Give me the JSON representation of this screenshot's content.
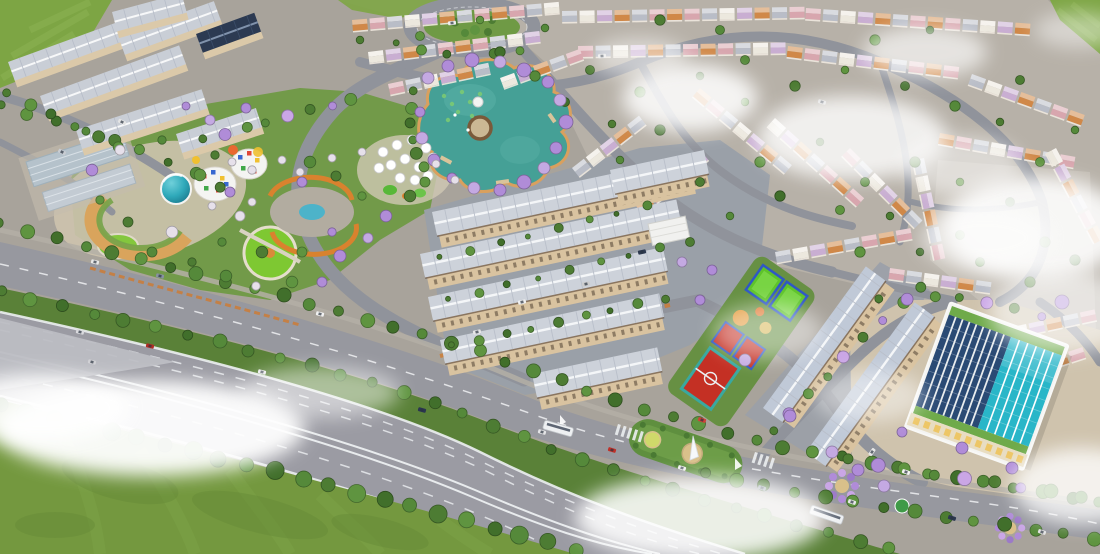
{
  "scene": {
    "type": "aerial-3d-render",
    "description": "Bird's-eye 3D architectural rendering of a master-planned township: parallel rows of shophouses, villa neighborhoods, a clover-shaped lake ringed with purple blossom trees, central park with colorful kindergarten, sports courts, a glass commercial tower, tree-lined boulevard, multi-lane highway and low drifting clouds.",
    "visible_text": []
  },
  "colors": {
    "base": "#a8a39b",
    "fieldGreen": "#7da544",
    "fieldLight": "#8db354",
    "grass": "#74983f",
    "grassDark": "#688c39",
    "treeGreen": "#4d7c33",
    "treeLight": "#61913d",
    "treeDark": "#3f6b2a",
    "treePurple": "#b08cd8",
    "treeWhite": "#e6e0ea",
    "road": "#90939b",
    "roadLight": "#9da3ab",
    "highway": "#9b9ba3",
    "gore": "#bcbdc3",
    "laneWhite": "#eceff1",
    "boulevard": "#97989f",
    "median": "#5a8138",
    "sidewalk": "#b4afa6",
    "villaGround": "#b7b1a8",
    "courtyard": "#c6c0b6",
    "lake": "#45a096",
    "lakeLight": "#5cb2a8",
    "lakeShore": "#d9a05e",
    "lily": "#7ac973",
    "island": "#cbb894",
    "islandRing": "#7a5a3a",
    "shopRoof": "#cdd2da",
    "shopRoofB": "#c0c9d7",
    "shopFacade": "#d9c3a0",
    "shopEave": "#6f5b49",
    "asphalt": "#9aa0a8",
    "aptRoof": "#c9ced6",
    "aptFacade": "#dbc9a9",
    "navyRoof": "#2c3a52",
    "warehouseA": "#b5c2cb",
    "warehouseB": "#c3cbd3",
    "plaza": "#cfc3ad",
    "parkGreen": "#6f9a45",
    "lawnBright": "#7ec832",
    "pathOrange": "#d9822e",
    "pathCream": "#e4ddcc",
    "pondBlue": "#4db3c9",
    "white": "#f4f4f2",
    "towerTeal": "#2fa9ba",
    "towerTealDark": "#19768a",
    "glassDark": "#2a4a74",
    "glassTeal": "#29b6c8",
    "mullion": "#e8ecee",
    "buildingGreen": "#6faa4a",
    "apron": "#e8ddc2",
    "apronWin": "#edc35c",
    "courtRed": "#c43024",
    "courtTealBorder": "#3aa8a0",
    "courtBlueBorder": "#2f58c4",
    "courtGreen": "#5ec32a",
    "courtGreenLight": "#7ed84a",
    "playOrange": "#e39a3a",
    "sandTan": "#d9c08a",
    "monumentGreen": "#5f8f3f",
    "hedge": "#4a7a33",
    "sailWhite": "#f6f8fa",
    "busWhite": "#eef0f2",
    "cloud": "#ffffff",
    "villaWall": "#efe9df"
  },
  "palettes": {
    "villaRoofs": [
      "#d08848",
      "#d8a6ae",
      "#b9bdc7",
      "#ece8de",
      "#c9aed2",
      "#d08848",
      "#b9bdc7",
      "#d8a6ae"
    ],
    "greens": [
      "#4d7c33",
      "#5f9440",
      "#416f2b",
      "#55893a"
    ],
    "mix": [
      "#4d7c33",
      "#b08cd8",
      "#5f9440",
      "#55893a",
      "#caa6e6"
    ],
    "parkMix": [
      "#4d7c33",
      "#5f9440",
      "#b08cd8",
      "#e6e0ea",
      "#55893a"
    ]
  },
  "villaRows": [
    [
      352,
      20,
      -5,
      12,
      0
    ],
    [
      562,
      11,
      -1,
      14,
      2
    ],
    [
      806,
      8,
      4,
      13,
      1
    ],
    [
      368,
      52,
      -7,
      10,
      3
    ],
    [
      578,
      46,
      -1,
      12,
      1
    ],
    [
      788,
      46,
      7,
      10,
      0
    ],
    [
      972,
      74,
      20,
      7,
      2
    ],
    [
      700,
      88,
      40,
      7,
      0
    ],
    [
      775,
      118,
      42,
      7,
      3
    ],
    [
      850,
      148,
      45,
      6,
      1
    ],
    [
      924,
      158,
      78,
      6,
      2
    ],
    [
      940,
      133,
      10,
      8,
      0
    ],
    [
      1056,
      148,
      62,
      6,
      3
    ],
    [
      935,
      395,
      -18,
      9,
      1
    ],
    [
      960,
      338,
      -12,
      8,
      0
    ],
    [
      572,
      168,
      -38,
      5,
      2
    ],
    [
      636,
      206,
      -40,
      5,
      0
    ],
    [
      775,
      252,
      -10,
      8,
      2
    ],
    [
      890,
      268,
      8,
      6,
      1
    ],
    [
      500,
      78,
      -20,
      5,
      3
    ],
    [
      388,
      84,
      -12,
      6,
      1
    ]
  ],
  "aptRows": [
    [
      8,
      62,
      -20,
      118,
      0
    ],
    [
      40,
      96,
      -20,
      148,
      0
    ],
    [
      76,
      130,
      -18,
      132,
      0
    ],
    [
      118,
      36,
      -20,
      102,
      0
    ],
    [
      176,
      134,
      -18,
      84,
      0
    ],
    [
      196,
      34,
      -20,
      62,
      1
    ],
    [
      112,
      12,
      -15,
      72,
      0
    ]
  ],
  "shopRows": [
    [
      432,
      212,
      264
    ],
    [
      420,
      254,
      262
    ],
    [
      428,
      297,
      240
    ],
    [
      440,
      340,
      224
    ],
    [
      532,
      374,
      128
    ],
    [
      610,
      170,
      96
    ]
  ],
  "rightRows": [
    [
      763,
      408,
      175
    ],
    [
      806,
      452,
      185
    ]
  ],
  "treeLines": [
    {
      "pts": [
        [
          0,
          224
        ],
        [
          260,
          290
        ],
        [
          470,
          348
        ],
        [
          620,
          402
        ],
        [
          760,
          442
        ],
        [
          900,
          468
        ],
        [
          1100,
          502
        ]
      ],
      "n": 40,
      "r": 6,
      "pal": "greens"
    },
    {
      "pts": [
        [
          0,
          292
        ],
        [
          220,
          342
        ],
        [
          400,
          390
        ],
        [
          510,
          432
        ],
        [
          610,
          470
        ],
        [
          700,
          498
        ],
        [
          800,
          526
        ],
        [
          890,
          548
        ]
      ],
      "n": 30,
      "r": 6,
      "pal": "greens"
    },
    {
      "pts": [
        [
          0,
          406
        ],
        [
          180,
          448
        ],
        [
          340,
          488
        ],
        [
          480,
          524
        ],
        [
          575,
          550
        ]
      ],
      "n": 22,
      "r": 8,
      "pal": "greens"
    },
    {
      "pts": [
        [
          705,
          474
        ],
        [
          840,
          500
        ],
        [
          980,
          522
        ],
        [
          1095,
          538
        ]
      ],
      "n": 14,
      "r": 6,
      "pal": "greens"
    },
    {
      "pts": [
        [
          848,
          460
        ],
        [
          960,
          478
        ],
        [
          1080,
          496
        ]
      ],
      "n": 9,
      "r": 6,
      "pal": "mix"
    },
    {
      "pts": [
        [
          452,
          346
        ],
        [
          560,
          322
        ],
        [
          665,
          298
        ]
      ],
      "n": 9,
      "r": 4,
      "pal": "greens"
    },
    {
      "pts": [
        [
          204,
          140
        ],
        [
          280,
          118
        ],
        [
          352,
          100
        ]
      ],
      "n": 8,
      "r": 5,
      "pal": "mix"
    },
    {
      "pts": [
        [
          415,
          92
        ],
        [
          408,
          132
        ],
        [
          424,
          168
        ]
      ],
      "n": 6,
      "r": 5,
      "pal": "greens"
    },
    {
      "pts": [
        [
          772,
          432
        ],
        [
          830,
          372
        ],
        [
          882,
          320
        ],
        [
          922,
          286
        ]
      ],
      "n": 9,
      "r": 5,
      "pal": "mix"
    },
    {
      "pts": [
        [
          0,
          106
        ],
        [
          80,
          128
        ],
        [
          160,
          158
        ],
        [
          222,
          186
        ]
      ],
      "n": 9,
      "r": 5,
      "pal": "greens"
    },
    {
      "pts": [
        [
          6,
          94
        ],
        [
          60,
          118
        ],
        [
          120,
          148
        ]
      ],
      "n": 6,
      "r": 5,
      "pal": "greens"
    },
    {
      "pts": [
        [
          448,
          300
        ],
        [
          560,
          272
        ],
        [
          660,
          248
        ]
      ],
      "n": 8,
      "r": 3.5,
      "pal": "greens"
    },
    {
      "pts": [
        [
          440,
          258
        ],
        [
          550,
          230
        ],
        [
          648,
          206
        ]
      ],
      "n": 8,
      "r": 3.5,
      "pal": "greens"
    },
    {
      "pts": [
        [
          880,
          300
        ],
        [
          960,
          296
        ],
        [
          1040,
          316
        ]
      ],
      "n": 7,
      "r": 5,
      "pal": "mix"
    },
    {
      "pts": [
        [
          398,
          44
        ],
        [
          452,
          56
        ],
        [
          520,
          52
        ]
      ],
      "n": 6,
      "r": 4,
      "pal": "greens"
    }
  ],
  "treePoints": [
    [
      360,
      40
    ],
    [
      420,
      36
    ],
    [
      500,
      52
    ],
    [
      545,
      28
    ],
    [
      590,
      70
    ],
    [
      640,
      92
    ],
    [
      700,
      76
    ],
    [
      745,
      60
    ],
    [
      795,
      86
    ],
    [
      845,
      70
    ],
    [
      905,
      86
    ],
    [
      955,
      106
    ],
    [
      1000,
      122
    ],
    [
      1040,
      162
    ],
    [
      660,
      130
    ],
    [
      620,
      160
    ],
    [
      700,
      182
    ],
    [
      760,
      162
    ],
    [
      820,
      142
    ],
    [
      865,
      182
    ],
    [
      915,
      162
    ],
    [
      960,
      182
    ],
    [
      1010,
      202
    ],
    [
      1045,
      242
    ],
    [
      890,
      216
    ],
    [
      840,
      210
    ],
    [
      780,
      196
    ],
    [
      730,
      216
    ],
    [
      690,
      242
    ],
    [
      860,
      252
    ],
    [
      920,
      252
    ],
    [
      980,
      262
    ],
    [
      1030,
      282
    ],
    [
      745,
      102
    ],
    [
      565,
      102
    ],
    [
      535,
      76
    ],
    [
      612,
      124
    ],
    [
      960,
      235
    ],
    [
      1075,
      260
    ],
    [
      1075,
      130
    ],
    [
      1020,
      80
    ],
    [
      875,
      40
    ],
    [
      930,
      30
    ],
    [
      720,
      30
    ],
    [
      660,
      20
    ],
    [
      480,
      20
    ]
  ],
  "parkTrees": [
    [
      215,
      155
    ],
    [
      200,
      175
    ],
    [
      230,
      192
    ],
    [
      252,
      170
    ],
    [
      310,
      162
    ],
    [
      336,
      176
    ],
    [
      362,
      196
    ],
    [
      386,
      216
    ],
    [
      240,
      216
    ],
    [
      222,
      242
    ],
    [
      262,
      252
    ],
    [
      302,
      252
    ],
    [
      332,
      232
    ],
    [
      172,
      232
    ],
    [
      152,
      252
    ],
    [
      192,
      262
    ],
    [
      292,
      282
    ],
    [
      322,
      282
    ],
    [
      256,
      286
    ],
    [
      226,
      276
    ],
    [
      128,
      222
    ],
    [
      100,
      200
    ],
    [
      92,
      170
    ],
    [
      120,
      150
    ],
    [
      162,
      140
    ],
    [
      410,
      196
    ],
    [
      425,
      182
    ]
  ],
  "purplePoints": [
    [
      428,
      78,
      6
    ],
    [
      448,
      66,
      6
    ],
    [
      472,
      60,
      7
    ],
    [
      500,
      62,
      6
    ],
    [
      524,
      70,
      7
    ],
    [
      548,
      82,
      6
    ],
    [
      560,
      100,
      6
    ],
    [
      566,
      122,
      7
    ],
    [
      556,
      148,
      6
    ],
    [
      544,
      168,
      6
    ],
    [
      524,
      182,
      7
    ],
    [
      500,
      190,
      6
    ],
    [
      474,
      188,
      6
    ],
    [
      452,
      178,
      5
    ],
    [
      434,
      160,
      6
    ],
    [
      422,
      138,
      6
    ],
    [
      420,
      112,
      5
    ],
    [
      340,
      256,
      6
    ],
    [
      368,
      238,
      5
    ],
    [
      302,
      182,
      5
    ],
    [
      858,
      470,
      6
    ],
    [
      884,
      486,
      6
    ],
    [
      1062,
      302,
      7
    ],
    [
      1012,
      468,
      6
    ],
    [
      745,
      360,
      6
    ],
    [
      700,
      300,
      5
    ],
    [
      790,
      416,
      6
    ],
    [
      832,
      452,
      6
    ],
    [
      902,
      432,
      5
    ],
    [
      962,
      448,
      6
    ],
    [
      210,
      120,
      5
    ],
    [
      246,
      108,
      5
    ],
    [
      186,
      106,
      4
    ],
    [
      682,
      262,
      5
    ],
    [
      712,
      270,
      5
    ]
  ],
  "whitePoints": [
    [
      455,
      180,
      4
    ],
    [
      436,
      164,
      4
    ],
    [
      300,
      172,
      4
    ],
    [
      332,
      158,
      4
    ],
    [
      362,
      152,
      4
    ],
    [
      232,
      162,
      4
    ],
    [
      252,
      202,
      4
    ],
    [
      212,
      206,
      4
    ],
    [
      282,
      160,
      4
    ]
  ],
  "umbrellas": [
    [
      383,
      152
    ],
    [
      397,
      145
    ],
    [
      412,
      140
    ],
    [
      426,
      148
    ],
    [
      391,
      165
    ],
    [
      405,
      159
    ],
    [
      419,
      167
    ],
    [
      433,
      158
    ],
    [
      379,
      168
    ],
    [
      400,
      178
    ],
    [
      415,
      180
    ],
    [
      428,
      176
    ]
  ],
  "lily": [
    [
      444,
      96
    ],
    [
      452,
      104
    ],
    [
      462,
      92
    ],
    [
      470,
      102
    ],
    [
      480,
      94
    ],
    [
      458,
      112
    ],
    [
      472,
      116
    ],
    [
      448,
      120
    ]
  ],
  "kinderDots": [
    [
      204,
      176,
      "#e04838"
    ],
    [
      213,
      172,
      "#3868d0"
    ],
    [
      222,
      178,
      "#f0c030"
    ],
    [
      206,
      188,
      "#40a848"
    ],
    [
      218,
      190,
      "#e04838"
    ],
    [
      226,
      184,
      "#3868d0"
    ],
    [
      240,
      157,
      "#3868d0"
    ],
    [
      249,
      153,
      "#e04838"
    ],
    [
      257,
      160,
      "#f0c030"
    ],
    [
      243,
      168,
      "#40a848"
    ],
    [
      254,
      171,
      "#e04838"
    ]
  ],
  "cars": [
    [
      95,
      262,
      13,
      "#e8e8e8"
    ],
    [
      160,
      276,
      13,
      "#8892a0"
    ],
    [
      320,
      314,
      14,
      "#f2f2f2"
    ],
    [
      80,
      332,
      13,
      "#dadade"
    ],
    [
      150,
      346,
      13,
      "#b02c24"
    ],
    [
      262,
      372,
      14,
      "#ececec"
    ],
    [
      422,
      410,
      15,
      "#2a3550"
    ],
    [
      92,
      362,
      13,
      "#d0d0d4"
    ],
    [
      542,
      432,
      16,
      "#e4e4e6"
    ],
    [
      612,
      450,
      17,
      "#c03028"
    ],
    [
      682,
      468,
      17,
      "#f0f0f0"
    ],
    [
      762,
      488,
      18,
      "#94a0ac"
    ],
    [
      852,
      502,
      18,
      "#e8e8ea"
    ],
    [
      952,
      518,
      18,
      "#2c3850"
    ],
    [
      1042,
      532,
      18,
      "#e2e2e2"
    ],
    [
      702,
      420,
      18,
      "#d04038"
    ],
    [
      906,
      472,
      18,
      "#f4f4f4"
    ],
    [
      522,
      302,
      -12,
      "#efefef"
    ],
    [
      586,
      284,
      -12,
      "#cccccc"
    ],
    [
      642,
      252,
      -12,
      "#2e3a50"
    ],
    [
      477,
      332,
      -12,
      "#e6e6e6"
    ],
    [
      602,
      56,
      -4,
      "#e8e8e8"
    ],
    [
      822,
      102,
      15,
      "#d8d8d8"
    ],
    [
      452,
      23,
      -6,
      "#eeeeee"
    ],
    [
      122,
      122,
      25,
      "#e4e4e4"
    ],
    [
      62,
      152,
      28,
      "#c8ccd2"
    ],
    [
      872,
      452,
      -54,
      "#e6e6e6"
    ]
  ],
  "buses": [
    [
      545,
      420,
      16,
      30
    ],
    [
      812,
      505,
      19,
      34
    ]
  ],
  "clouds": [
    [
      150,
      428,
      155,
      48,
      0.95
    ],
    [
      40,
      408,
      90,
      34,
      0.9
    ],
    [
      320,
      392,
      80,
      26,
      0.5
    ],
    [
      690,
      98,
      68,
      34,
      0.85
    ],
    [
      852,
      138,
      95,
      42,
      0.8
    ],
    [
      1035,
      228,
      92,
      52,
      0.88
    ],
    [
      925,
      52,
      62,
      26,
      0.65
    ],
    [
      1062,
      312,
      72,
      42,
      0.6
    ],
    [
      700,
      518,
      125,
      42,
      0.88
    ],
    [
      1082,
      486,
      70,
      38,
      0.78
    ],
    [
      768,
      332,
      55,
      28,
      0.45
    ],
    [
      985,
      238,
      65,
      32,
      0.55
    ],
    [
      640,
      58,
      48,
      20,
      0.5
    ],
    [
      870,
      396,
      55,
      26,
      0.45
    ],
    [
      962,
      166,
      60,
      30,
      0.5
    ],
    [
      1078,
      30,
      44,
      18,
      0.45
    ]
  ]
}
